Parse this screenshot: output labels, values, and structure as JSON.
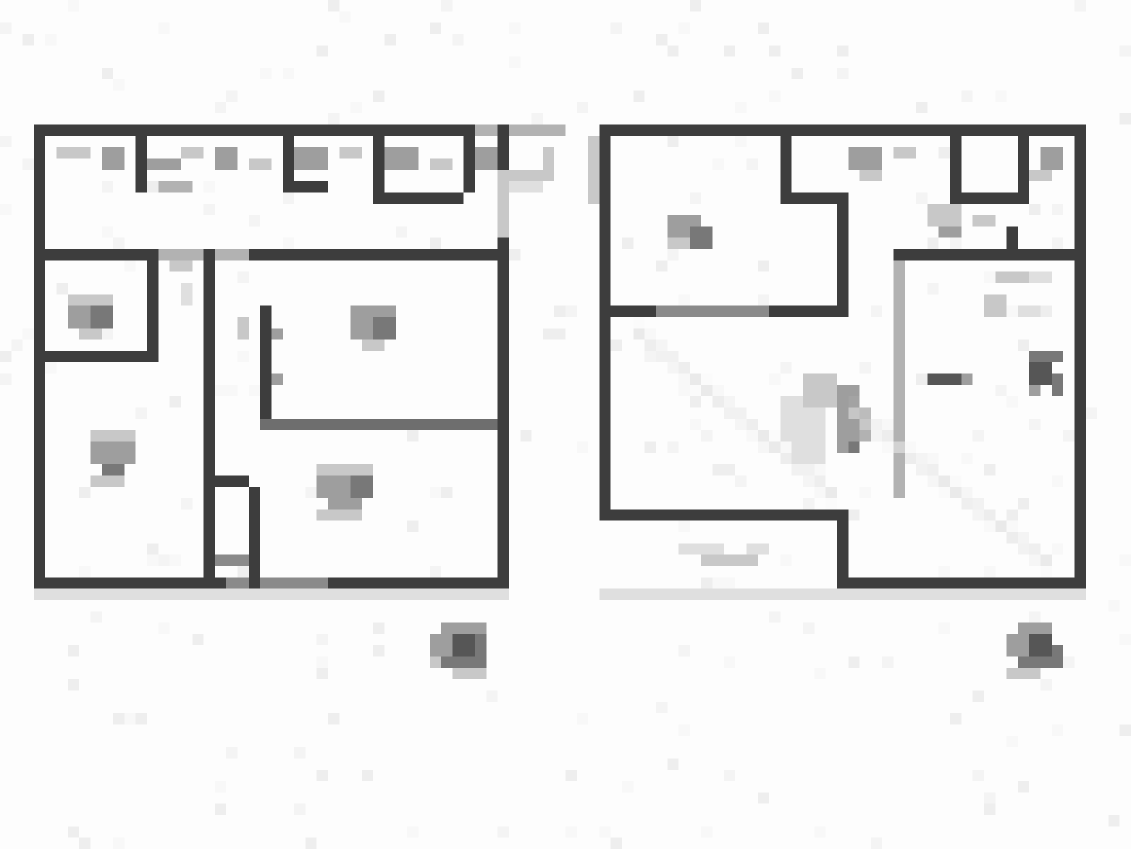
{
  "image": {
    "kind": "pixelated-floor-plan-pair",
    "bg": "#fdfdfd",
    "grid_w": 100,
    "grid_h": 75,
    "palette": {
      "wall": "#3d3d3d",
      "wall_med": "#6e6e6e",
      "wall_soft": "#8a8a8a",
      "ink": "#565656",
      "ink2": "#787878",
      "gray": "#9e9e9e",
      "gray_med": "#b2b2b2",
      "gray_light": "#c8c8c8",
      "gray_faint": "#dfdfdf"
    },
    "noise": {
      "count": 260,
      "seed": 7,
      "colors": [
        "#f4f4f4",
        "#eeeeee",
        "#f8f8f8"
      ]
    }
  },
  "plans": [
    {
      "id": "left-floor-plan",
      "rects": [
        [
          3,
          11,
          39,
          1,
          "wall"
        ],
        [
          42,
          11,
          8,
          1,
          "gray_med"
        ],
        [
          3,
          11,
          1,
          41,
          "wall"
        ],
        [
          3,
          51,
          42,
          1,
          "wall"
        ],
        [
          20,
          51,
          9,
          1,
          "wall_soft"
        ],
        [
          3,
          52,
          42,
          1,
          "gray_faint"
        ],
        [
          44,
          11,
          1,
          4,
          "wall"
        ],
        [
          44,
          15,
          1,
          6,
          "gray_light"
        ],
        [
          44,
          21,
          1,
          31,
          "wall"
        ],
        [
          3,
          22,
          10,
          1,
          "wall"
        ],
        [
          13,
          22,
          9,
          1,
          "gray_med"
        ],
        [
          22,
          22,
          22,
          1,
          "wall"
        ],
        [
          12,
          12,
          1,
          5,
          "wall"
        ],
        [
          25,
          11,
          1,
          6,
          "wall"
        ],
        [
          25,
          16,
          4,
          1,
          "wall"
        ],
        [
          33,
          12,
          1,
          5,
          "wall"
        ],
        [
          41,
          12,
          1,
          5,
          "wall"
        ],
        [
          33,
          17,
          8,
          1,
          "wall"
        ],
        [
          13,
          22,
          1,
          9,
          "wall"
        ],
        [
          3,
          31,
          11,
          1,
          "wall"
        ],
        [
          18,
          22,
          1,
          30,
          "wall"
        ],
        [
          19,
          42,
          3,
          1,
          "wall"
        ],
        [
          22,
          43,
          1,
          9,
          "wall"
        ],
        [
          19,
          49,
          3,
          1,
          "wall_soft"
        ],
        [
          23,
          27,
          1,
          10,
          "wall"
        ],
        [
          23,
          37,
          21,
          1,
          "wall_med"
        ],
        [
          5,
          13,
          3,
          1,
          "gray_light"
        ],
        [
          9,
          13,
          2,
          2,
          "gray"
        ],
        [
          13,
          14,
          3,
          1,
          "gray"
        ],
        [
          16,
          13,
          2,
          1,
          "gray_light"
        ],
        [
          19,
          13,
          2,
          2,
          "gray"
        ],
        [
          22,
          14,
          2,
          1,
          "gray_light"
        ],
        [
          26,
          13,
          3,
          2,
          "gray"
        ],
        [
          30,
          13,
          2,
          1,
          "gray_light"
        ],
        [
          34,
          13,
          3,
          2,
          "gray"
        ],
        [
          38,
          14,
          2,
          1,
          "gray_light"
        ],
        [
          42,
          13,
          2,
          2,
          "gray"
        ],
        [
          14,
          16,
          3,
          1,
          "gray_med"
        ],
        [
          6,
          26,
          4,
          1,
          "gray_light"
        ],
        [
          6,
          27,
          2,
          2,
          "gray"
        ],
        [
          8,
          27,
          2,
          2,
          "ink2"
        ],
        [
          7,
          29,
          2,
          1,
          "gray_light"
        ],
        [
          15,
          23,
          2,
          1,
          "gray_light"
        ],
        [
          16,
          25,
          1,
          2,
          "gray_faint"
        ],
        [
          45,
          15,
          4,
          1,
          "gray_light"
        ],
        [
          45,
          16,
          3,
          1,
          "gray_faint"
        ],
        [
          48,
          13,
          1,
          3,
          "gray_light"
        ],
        [
          31,
          27,
          4,
          1,
          "gray"
        ],
        [
          31,
          28,
          2,
          2,
          "gray"
        ],
        [
          33,
          28,
          2,
          2,
          "ink2"
        ],
        [
          32,
          30,
          2,
          1,
          "gray_light"
        ],
        [
          24,
          29,
          1,
          1,
          "gray"
        ],
        [
          24,
          33,
          1,
          1,
          "gray"
        ],
        [
          21,
          28,
          1,
          2,
          "gray_light"
        ],
        [
          28,
          41,
          5,
          1,
          "gray_light"
        ],
        [
          28,
          42,
          3,
          2,
          "gray"
        ],
        [
          31,
          42,
          2,
          2,
          "ink2"
        ],
        [
          29,
          44,
          3,
          1,
          "gray"
        ],
        [
          28,
          45,
          4,
          1,
          "gray_light"
        ],
        [
          8,
          38,
          4,
          1,
          "gray_light"
        ],
        [
          8,
          39,
          2,
          2,
          "gray"
        ],
        [
          10,
          39,
          2,
          2,
          "gray"
        ],
        [
          9,
          41,
          2,
          1,
          "ink2"
        ],
        [
          8,
          42,
          3,
          1,
          "gray_light"
        ]
      ],
      "lines": [],
      "caption": {
        "rects": [
          [
            39,
            55,
            4,
            1,
            "gray"
          ],
          [
            38,
            56,
            2,
            2,
            "gray"
          ],
          [
            40,
            56,
            2,
            2,
            "ink"
          ],
          [
            42,
            56,
            1,
            2,
            "ink2"
          ],
          [
            39,
            58,
            4,
            1,
            "ink2"
          ],
          [
            38,
            58,
            1,
            1,
            "gray_light"
          ],
          [
            40,
            59,
            3,
            1,
            "gray_light"
          ]
        ]
      }
    },
    {
      "id": "right-floor-plan",
      "rects": [
        [
          53,
          11,
          43,
          1,
          "wall"
        ],
        [
          53,
          11,
          1,
          35,
          "wall"
        ],
        [
          53,
          45,
          22,
          1,
          "wall"
        ],
        [
          74,
          45,
          1,
          7,
          "wall"
        ],
        [
          74,
          51,
          22,
          1,
          "wall"
        ],
        [
          53,
          52,
          43,
          1,
          "gray_faint"
        ],
        [
          95,
          11,
          1,
          41,
          "wall"
        ],
        [
          53,
          27,
          5,
          1,
          "wall"
        ],
        [
          58,
          27,
          10,
          1,
          "wall_soft"
        ],
        [
          68,
          27,
          7,
          1,
          "wall"
        ],
        [
          69,
          11,
          1,
          7,
          "wall"
        ],
        [
          69,
          17,
          6,
          1,
          "wall"
        ],
        [
          74,
          17,
          1,
          10,
          "wall"
        ],
        [
          79,
          22,
          17,
          1,
          "wall"
        ],
        [
          89,
          20,
          1,
          3,
          "wall"
        ],
        [
          84,
          12,
          1,
          5,
          "wall"
        ],
        [
          84,
          17,
          6,
          1,
          "wall"
        ],
        [
          90,
          12,
          1,
          6,
          "wall"
        ],
        [
          79,
          23,
          1,
          21,
          "gray_med"
        ],
        [
          52,
          12,
          1,
          6,
          "gray_light"
        ],
        [
          75,
          13,
          3,
          2,
          "gray"
        ],
        [
          79,
          13,
          2,
          1,
          "gray_light"
        ],
        [
          76,
          15,
          2,
          1,
          "gray_light"
        ],
        [
          82,
          18,
          3,
          2,
          "gray_light"
        ],
        [
          86,
          19,
          2,
          1,
          "gray_light"
        ],
        [
          83,
          20,
          2,
          1,
          "gray"
        ],
        [
          59,
          19,
          3,
          2,
          "gray"
        ],
        [
          61,
          20,
          2,
          2,
          "ink2"
        ],
        [
          59,
          21,
          2,
          1,
          "gray_light"
        ],
        [
          92,
          13,
          2,
          2,
          "gray"
        ],
        [
          91,
          15,
          2,
          1,
          "gray_light"
        ],
        [
          88,
          24,
          3,
          1,
          "gray_light"
        ],
        [
          91,
          24,
          2,
          1,
          "gray_faint"
        ],
        [
          87,
          26,
          2,
          2,
          "gray_light"
        ],
        [
          90,
          27,
          2,
          1,
          "gray_faint"
        ],
        [
          82,
          33,
          3,
          1,
          "ink"
        ],
        [
          85,
          33,
          1,
          1,
          "gray"
        ],
        [
          91,
          31,
          3,
          1,
          "ink2"
        ],
        [
          91,
          32,
          2,
          2,
          "ink"
        ],
        [
          93,
          33,
          1,
          2,
          "ink2"
        ],
        [
          91,
          34,
          1,
          1,
          "gray"
        ],
        [
          69,
          35,
          4,
          4,
          "gray_faint"
        ],
        [
          71,
          33,
          3,
          3,
          "gray_light"
        ],
        [
          74,
          34,
          2,
          6,
          "gray"
        ],
        [
          76,
          36,
          1,
          3,
          "gray_med"
        ],
        [
          75,
          39,
          1,
          1,
          "ink2"
        ],
        [
          70,
          39,
          3,
          2,
          "gray_faint"
        ],
        [
          60,
          48,
          4,
          1,
          "gray_faint"
        ],
        [
          62,
          49,
          5,
          1,
          "gray_light"
        ],
        [
          66,
          48,
          2,
          1,
          "gray_faint"
        ]
      ],
      "lines": [
        [
          56,
          29,
          74,
          44,
          "gray_faint"
        ],
        [
          75,
          36,
          93,
          50,
          "gray_faint"
        ]
      ],
      "caption": {
        "rects": [
          [
            90,
            55,
            3,
            1,
            "gray"
          ],
          [
            89,
            56,
            2,
            2,
            "gray"
          ],
          [
            91,
            56,
            2,
            2,
            "ink"
          ],
          [
            93,
            57,
            1,
            2,
            "ink2"
          ],
          [
            90,
            58,
            3,
            1,
            "ink2"
          ],
          [
            89,
            59,
            3,
            1,
            "gray_light"
          ]
        ]
      }
    }
  ]
}
